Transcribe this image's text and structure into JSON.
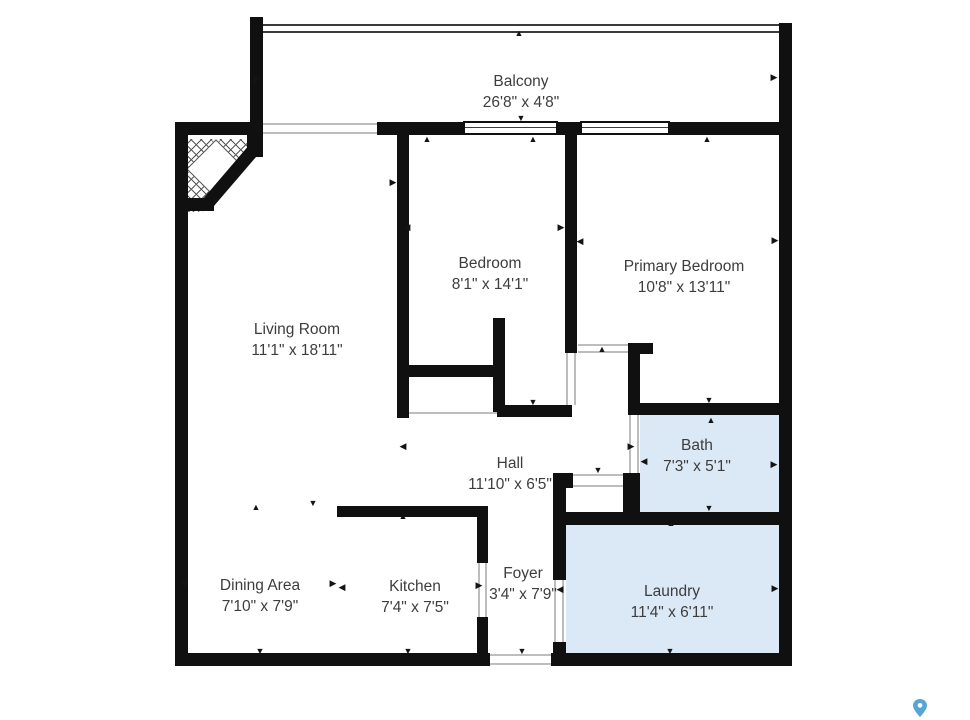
{
  "plan": {
    "title": "Apartment floor plan",
    "colors": {
      "background": "#ffffff",
      "wall": "#101010",
      "wet": "#dbe8f6",
      "label": "#3d3d3d",
      "pin": "#55a5d6"
    },
    "wet_rooms": [
      "Bath",
      "Laundry"
    ]
  },
  "rooms": [
    {
      "name": "Balcony",
      "dims": "26'8\" x 4'8\""
    },
    {
      "name": "Bedroom",
      "dims": "8'1\" x 14'1\""
    },
    {
      "name": "Primary Bedroom",
      "dims": "10'8\" x 13'11\""
    },
    {
      "name": "Living Room",
      "dims": "11'1\" x 18'11\""
    },
    {
      "name": "Bath",
      "dims": "7'3\" x 5'1\""
    },
    {
      "name": "Hall",
      "dims": "11'10\" x 6'5\""
    },
    {
      "name": "Dining Area",
      "dims": "7'10\" x 7'9\""
    },
    {
      "name": "Kitchen",
      "dims": "7'4\" x 7'5\""
    },
    {
      "name": "Foyer",
      "dims": "3'4\" x 7'9\""
    },
    {
      "name": "Laundry",
      "dims": "11'4\" x 6'11\""
    }
  ]
}
